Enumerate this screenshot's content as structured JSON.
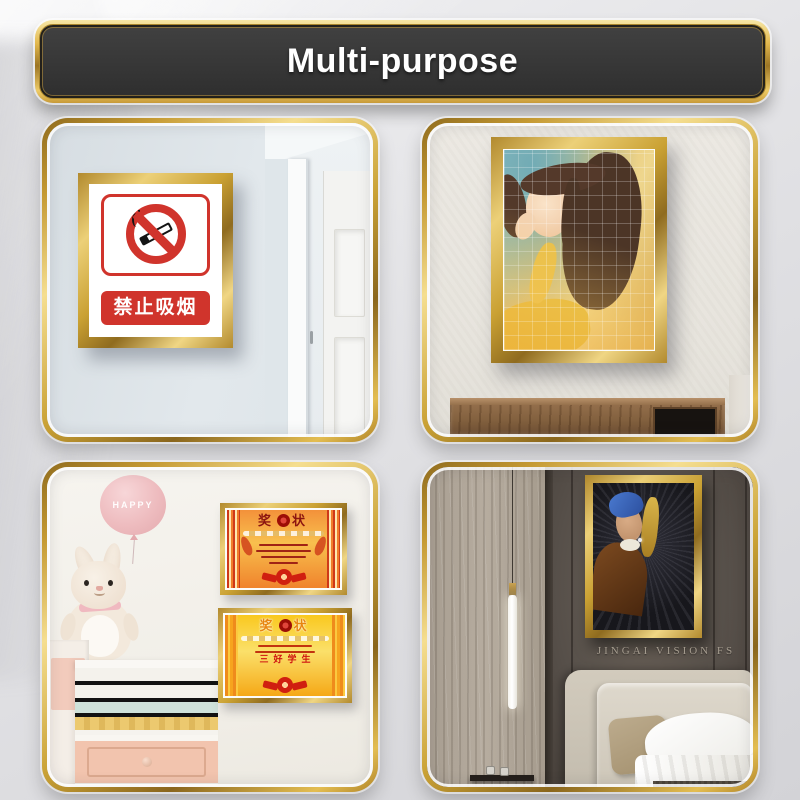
{
  "banner": {
    "title": "Multi-purpose"
  },
  "panels": {
    "no_smoking": {
      "sign_text": "禁止吸烟"
    },
    "kids_room": {
      "balloon_text": "HAPPY",
      "certificate_top": {
        "title_left": "奖",
        "title_right": "状"
      },
      "certificate_bottom": {
        "title_left": "奖",
        "title_right": "状",
        "center_text": "三好学生"
      }
    },
    "bedroom": {
      "watermark": "JINGAI VISION FS"
    }
  },
  "colors": {
    "gold_accent": "#d4af37",
    "banner_background": "#383838",
    "sign_red": "#d0342c",
    "certificate_orange": "#f0832c",
    "certificate_yellow": "#f9c81f",
    "balloon_pink": "#eebcbf"
  }
}
